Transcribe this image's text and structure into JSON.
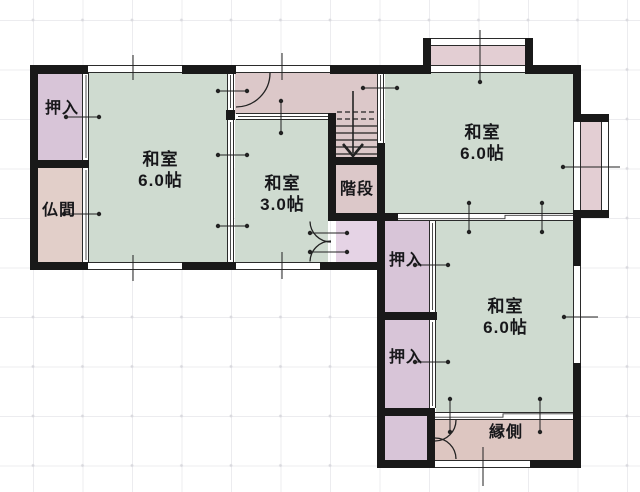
{
  "plan": {
    "type": "japanese-residence-floor-plan",
    "rooms": [
      {
        "name": "oshiire-top-left",
        "label": "押入"
      },
      {
        "name": "butsuma",
        "label": "仏間"
      },
      {
        "name": "washitsu-left",
        "label": "和室",
        "size": "6.0帖"
      },
      {
        "name": "washitsu-center",
        "label": "和室",
        "size": "3.0帖"
      },
      {
        "name": "kaidan",
        "label": "階段"
      },
      {
        "name": "washitsu-top-right",
        "label": "和室",
        "size": "6.0帖"
      },
      {
        "name": "oshiire-right-1",
        "label": "押入"
      },
      {
        "name": "oshiire-right-2",
        "label": "押入"
      },
      {
        "name": "washitsu-bottom-right",
        "label": "和室",
        "size": "6.0帖"
      },
      {
        "name": "engawa",
        "label": "縁側"
      }
    ],
    "colors": {
      "wall": "#191919",
      "tatami_room": "#cfdbd0",
      "closet": "#d8c5d8",
      "butsuma": "#e2cfc9",
      "hall_stairs": "#dcc8c9",
      "understairs_closet": "#e5d3e5",
      "engawa": "#ddc6c1",
      "bay_window": "#e3ced3",
      "grid_line": "#ececef"
    }
  }
}
